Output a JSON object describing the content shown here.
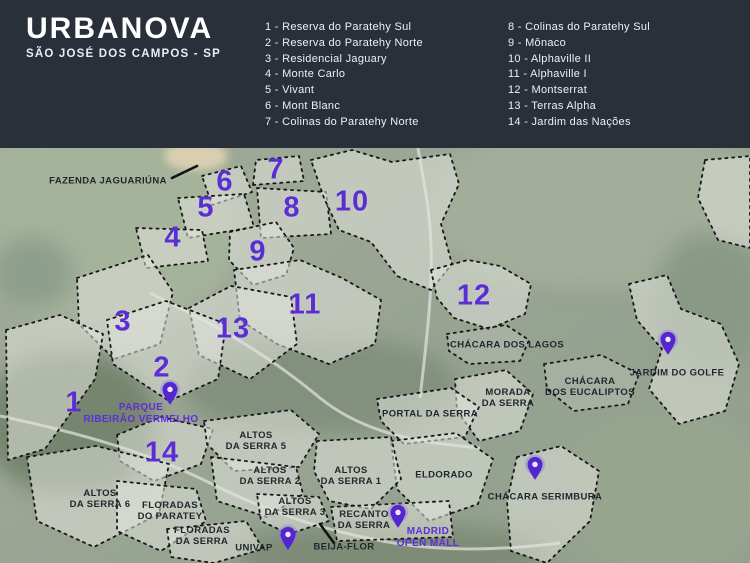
{
  "header": {
    "title": "URBANOVA",
    "subtitle": "SÃO JOSÉ DOS CAMPOS - SP",
    "legend_col1": [
      {
        "num": "1",
        "name": "Reserva do Paratehy Sul"
      },
      {
        "num": "2",
        "name": "Reserva do Paratehy Norte"
      },
      {
        "num": "3",
        "name": "Residencial Jaguary"
      },
      {
        "num": "4",
        "name": "Monte Carlo"
      },
      {
        "num": "5",
        "name": "Vivant"
      },
      {
        "num": "6",
        "name": "Mont Blanc"
      },
      {
        "num": "7",
        "name": "Colinas do Paratehy Norte"
      }
    ],
    "legend_col2": [
      {
        "num": "8",
        "name": "Colinas do Paratehy Sul"
      },
      {
        "num": "9",
        "name": "Mônaco"
      },
      {
        "num": "10",
        "name": "Alphaville II"
      },
      {
        "num": "11",
        "name": "Alphaville I"
      },
      {
        "num": "12",
        "name": "Montserrat"
      },
      {
        "num": "13",
        "name": "Terras Alpha"
      },
      {
        "num": "14",
        "name": "Jardim das Nações"
      }
    ]
  },
  "map": {
    "region_numbers": [
      {
        "n": "1",
        "x": 74,
        "y": 255
      },
      {
        "n": "2",
        "x": 162,
        "y": 220
      },
      {
        "n": "3",
        "x": 123,
        "y": 174
      },
      {
        "n": "4",
        "x": 173,
        "y": 90
      },
      {
        "n": "5",
        "x": 206,
        "y": 60
      },
      {
        "n": "6",
        "x": 225,
        "y": 34
      },
      {
        "n": "7",
        "x": 276,
        "y": 22
      },
      {
        "n": "8",
        "x": 292,
        "y": 60
      },
      {
        "n": "9",
        "x": 258,
        "y": 104
      },
      {
        "n": "10",
        "x": 352,
        "y": 54
      },
      {
        "n": "11",
        "x": 305,
        "y": 157
      },
      {
        "n": "12",
        "x": 474,
        "y": 148
      },
      {
        "n": "13",
        "x": 233,
        "y": 181
      },
      {
        "n": "14",
        "x": 162,
        "y": 305
      }
    ],
    "area_labels": [
      {
        "id": "fazenda-jaguariuna",
        "lines": [
          "FAZENDA JAGUARIÚNA"
        ],
        "x": 108,
        "y": 33,
        "purple": false
      },
      {
        "id": "chacara-dos-lagos",
        "lines": [
          "CHÁCARA DOS LAGOS"
        ],
        "x": 507,
        "y": 197,
        "purple": false
      },
      {
        "id": "jardim-do-golfe",
        "lines": [
          "JARDIM DO GOLFE"
        ],
        "x": 677,
        "y": 225,
        "purple": false
      },
      {
        "id": "chacara-dos-eucaliptos",
        "lines": [
          "CHÁCARA",
          "DOS EUCALIPTOS"
        ],
        "x": 590,
        "y": 239,
        "purple": false
      },
      {
        "id": "morada-da-serra",
        "lines": [
          "MORADA",
          "DA SERRA"
        ],
        "x": 508,
        "y": 250,
        "purple": false
      },
      {
        "id": "portal-da-serra",
        "lines": [
          "PORTAL DA SERRA"
        ],
        "x": 430,
        "y": 266,
        "purple": false
      },
      {
        "id": "eldorado",
        "lines": [
          "ELDORADO"
        ],
        "x": 444,
        "y": 327,
        "purple": false
      },
      {
        "id": "altos-da-serra-5",
        "lines": [
          "ALTOS",
          "DA SERRA 5"
        ],
        "x": 256,
        "y": 293,
        "purple": false
      },
      {
        "id": "altos-da-serra-2",
        "lines": [
          "ALTOS",
          "DA SERRA 2"
        ],
        "x": 270,
        "y": 328,
        "purple": false
      },
      {
        "id": "altos-da-serra-1",
        "lines": [
          "ALTOS",
          "DA SERRA 1"
        ],
        "x": 351,
        "y": 328,
        "purple": false
      },
      {
        "id": "altos-da-serra-6",
        "lines": [
          "ALTOS",
          "DA SERRA 6"
        ],
        "x": 100,
        "y": 351,
        "purple": false
      },
      {
        "id": "altos-da-serra-3",
        "lines": [
          "ALTOS",
          "DA SERRA 3"
        ],
        "x": 295,
        "y": 359,
        "purple": false
      },
      {
        "id": "floradas-do-paratey",
        "lines": [
          "FLORADAS",
          "DO PARATEY"
        ],
        "x": 170,
        "y": 363,
        "purple": false
      },
      {
        "id": "recanto-da-serra",
        "lines": [
          "RECANTO",
          "DA SERRA"
        ],
        "x": 364,
        "y": 372,
        "purple": false
      },
      {
        "id": "floradas-da-serra",
        "lines": [
          "FLORADAS",
          "DA SERRA"
        ],
        "x": 202,
        "y": 388,
        "purple": false
      },
      {
        "id": "chacara-serimbura",
        "lines": [
          "CHÁCARA SERIMBURA"
        ],
        "x": 545,
        "y": 349,
        "purple": false
      },
      {
        "id": "univap",
        "lines": [
          "UNIVAP"
        ],
        "x": 254,
        "y": 400,
        "purple": false
      },
      {
        "id": "beija-flor",
        "lines": [
          "BEIJA-FLOR"
        ],
        "x": 344,
        "y": 399,
        "purple": false
      },
      {
        "id": "parque-ribeirao-vermelho",
        "lines": [
          "PARQUE",
          "RIBEIRÃO VERMELHO"
        ],
        "x": 141,
        "y": 266,
        "purple": true
      },
      {
        "id": "madrid-open-mall",
        "lines": [
          "MADRID",
          "OPEN MALL"
        ],
        "x": 428,
        "y": 390,
        "purple": true
      }
    ],
    "pins": [
      {
        "id": "parque-ribeirao-vermelho-pin",
        "x": 170,
        "y": 256
      },
      {
        "id": "jardim-do-golfe-pin",
        "x": 668,
        "y": 206
      },
      {
        "id": "chacara-serimbura-pin",
        "x": 535,
        "y": 331
      },
      {
        "id": "univap-pin",
        "x": 288,
        "y": 401
      },
      {
        "id": "madrid-open-mall-pin",
        "x": 398,
        "y": 379
      }
    ],
    "colors": {
      "accent_purple": "#5b2ed3",
      "pin_purple": "#5426ce",
      "label_dark": "#22272e",
      "header_bg": "#2a303a"
    }
  }
}
